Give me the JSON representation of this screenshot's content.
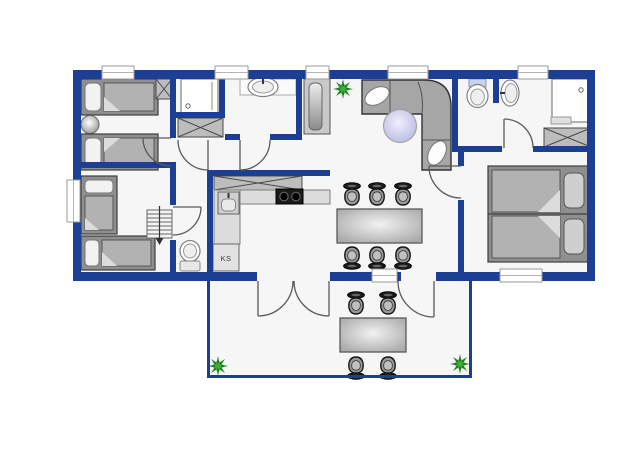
{
  "diagram": {
    "type": "floor-plan",
    "label_fridge": "KS"
  },
  "colors": {
    "wall": "#1c3f94",
    "floor": "#f6f6f6",
    "background": "#ffffff",
    "furniture_gray": "#a6a6a6",
    "counter_gray": "#d9d9d9",
    "plant_green_dark": "#1e7a1e",
    "plant_green_light": "#3fae3f",
    "table_lavender": "#c4c4ea",
    "stove_black": "#1b1b1b",
    "chair_dark": "#1a1a1a"
  },
  "inventory": {
    "bedrooms": 3,
    "single_beds": 4,
    "double_beds": 1,
    "bathrooms_with_shower": 2,
    "separate_wc": 1,
    "wardrobes": 3,
    "dining_chairs": 6,
    "terrace_chairs": 4,
    "plants": 3,
    "staircases": 1
  }
}
